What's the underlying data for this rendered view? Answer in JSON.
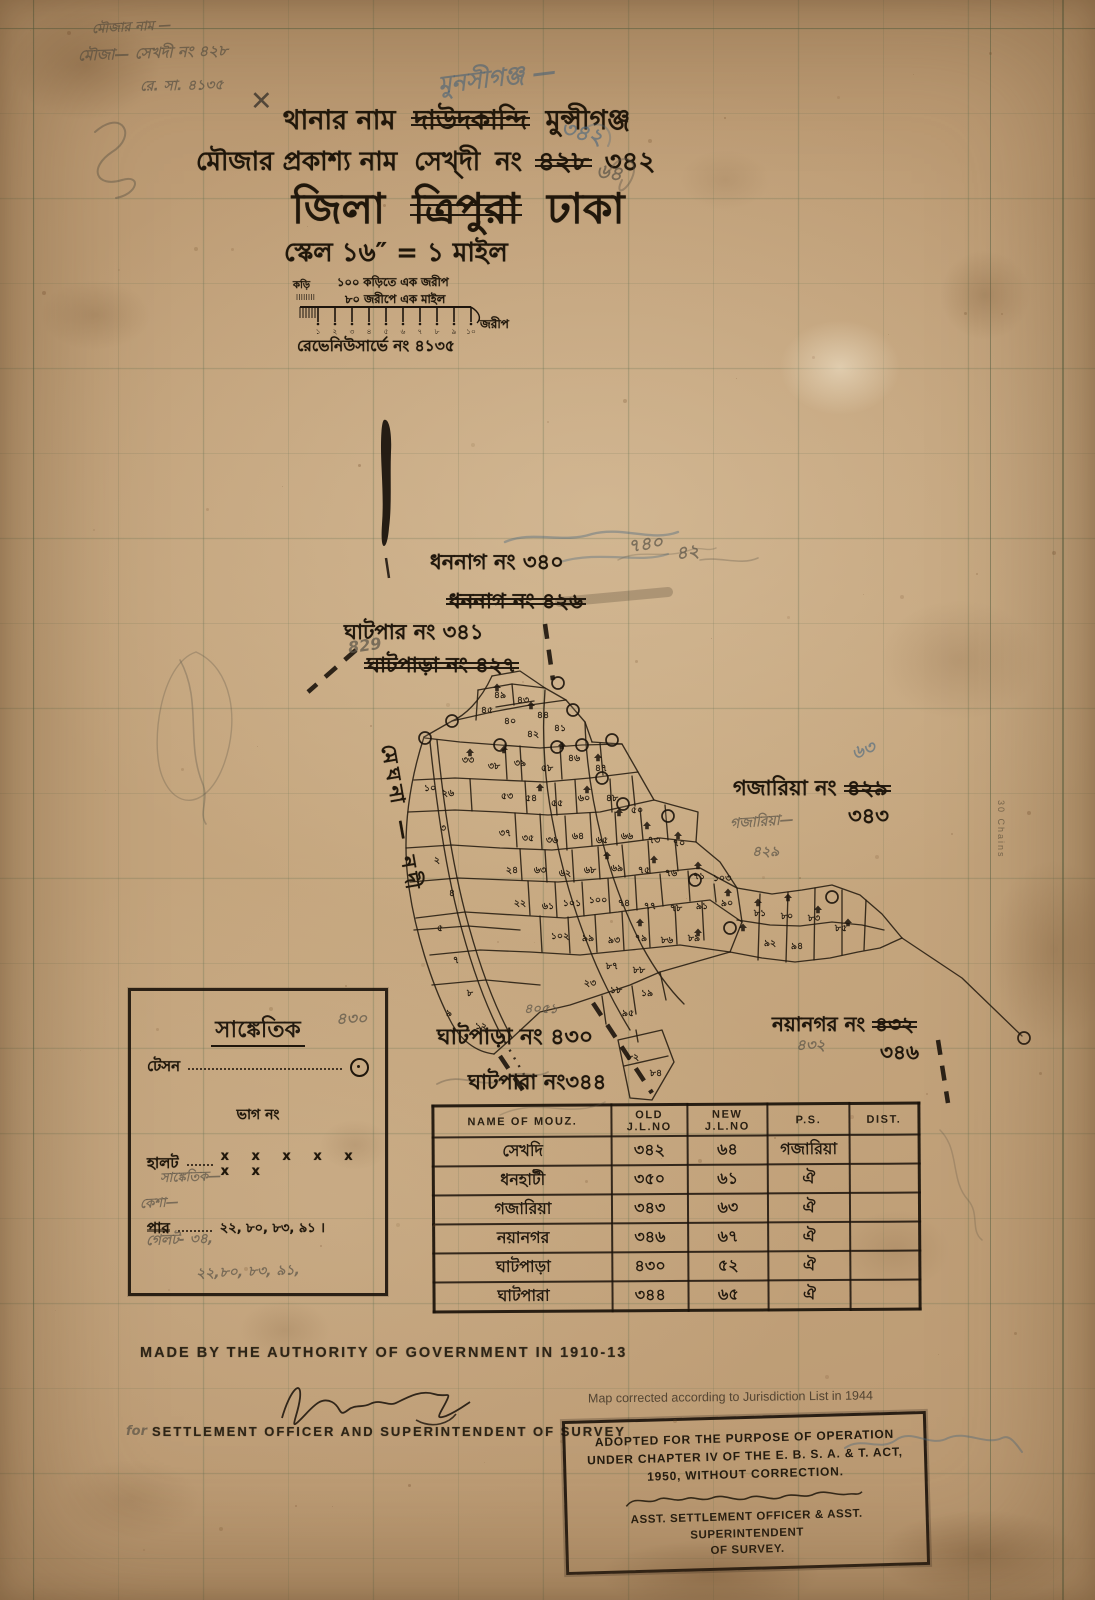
{
  "header": {
    "line1": {
      "prefix": "থানার নাম",
      "struck": "দাউদকান্দি",
      "value": "মুন্সীগঞ্জ"
    },
    "line2": {
      "prefix": "মৌজার প্রকাশ্য নাম",
      "name": "সেখ্দী",
      "no_label": "নং",
      "struck": "৪২৮",
      "value": "৩৪২"
    },
    "line3": {
      "prefix": "জিলা",
      "struck": "ত্রিপুরা",
      "value": "ঢাকা"
    },
    "scale_text": "স্কেল ১৬″ = ১ মাইল"
  },
  "scale_bar": {
    "label_top": "১০০ কড়িতে এক জরীপ",
    "label_bottom": "৮০ জরীপে এক মাইল",
    "label_left": "কড়ি",
    "label_right": "জরীপ",
    "ticks": [
      "১",
      "২",
      "৩",
      "৪",
      "৫",
      "৬",
      "৭",
      "৮",
      "৯",
      "১০"
    ]
  },
  "revenue_no": "রেভেনিউসার্ভে নং ৪১৩৫",
  "river_label": "মেঘনা — নদী",
  "margin": {
    "right_note": "30 Chains"
  },
  "boundary_labels": [
    {
      "x": 430,
      "y": 546,
      "s": 21,
      "parts": [
        {
          "t": "ধননাগ নং ৩৪০"
        }
      ]
    },
    {
      "x": 446,
      "y": 585,
      "s": 21,
      "parts": [
        {
          "t": "ধননাগ নং ৪২৬",
          "struck": true
        }
      ]
    },
    {
      "x": 344,
      "y": 616,
      "s": 21,
      "parts": [
        {
          "t": "ঘাটপার নং ৩৪১"
        }
      ]
    },
    {
      "x": 364,
      "y": 649,
      "s": 21,
      "parts": [
        {
          "t": "ঘাটপাড়া নং ৪২৭",
          "struck": true
        }
      ]
    },
    {
      "x": 733,
      "y": 772,
      "s": 21,
      "parts": [
        {
          "t": "গজারিয়া নং "
        },
        {
          "t": "৪২৯",
          "struck": true
        }
      ]
    },
    {
      "x": 848,
      "y": 800,
      "s": 21,
      "parts": [
        {
          "t": "৩৪৩"
        }
      ]
    },
    {
      "x": 772,
      "y": 1010,
      "s": 20,
      "parts": [
        {
          "t": "নয়ানগর নং "
        },
        {
          "t": "৪৩২",
          "struck": true
        }
      ]
    },
    {
      "x": 880,
      "y": 1038,
      "s": 20,
      "parts": [
        {
          "t": "৩৪৬"
        }
      ]
    },
    {
      "x": 437,
      "y": 1020,
      "s": 22,
      "parts": [
        {
          "t": "ঘাটপাড়া নং ৪৩০"
        }
      ]
    },
    {
      "x": 468,
      "y": 1066,
      "s": 21,
      "parts": [
        {
          "t": "ঘাটপারা নং৩৪৪"
        }
      ]
    }
  ],
  "pencil_notes": [
    {
      "x": 92,
      "y": 18,
      "t": "মৌজার নাম —",
      "c": "gray",
      "s": 13,
      "r": -3
    },
    {
      "x": 78,
      "y": 42,
      "t": "মৌজা— সেখদী নং ৪২৮",
      "c": "gray",
      "s": 15,
      "r": -2
    },
    {
      "x": 140,
      "y": 74,
      "t": "রে. সা. ৪১৩৫",
      "c": "gray",
      "s": 14,
      "r": -1
    },
    {
      "x": 438,
      "y": 60,
      "t": "মুনসীগঞ্জ —",
      "c": "blue",
      "s": 24,
      "r": -7
    },
    {
      "x": 560,
      "y": 116,
      "t": "৩৪২",
      "c": "blue",
      "s": 22,
      "r": 14
    },
    {
      "x": 596,
      "y": 158,
      "t": "৬৪",
      "c": "gray",
      "s": 20,
      "r": 10
    },
    {
      "x": 250,
      "y": 86,
      "t": "✕",
      "c": "dark",
      "s": 27,
      "r": 0
    },
    {
      "x": 628,
      "y": 530,
      "t": "৭৪০",
      "c": "gray",
      "s": 18,
      "r": -8
    },
    {
      "x": 676,
      "y": 538,
      "t": "৪২",
      "c": "gray",
      "s": 18,
      "r": -8
    },
    {
      "x": 348,
      "y": 636,
      "t": "829",
      "c": "gray",
      "s": 16,
      "r": -8
    },
    {
      "x": 852,
      "y": 736,
      "t": "৬৩",
      "c": "blue",
      "s": 18,
      "r": -18
    },
    {
      "x": 730,
      "y": 810,
      "t": "গজারিয়া—",
      "c": "gray",
      "s": 14,
      "r": -4
    },
    {
      "x": 752,
      "y": 840,
      "t": "৪২৯",
      "c": "gray",
      "s": 14,
      "r": 0
    },
    {
      "x": 524,
      "y": 1000,
      "t": "৪০৫১",
      "c": "gray",
      "s": 13,
      "r": 0
    },
    {
      "x": 336,
      "y": 1006,
      "t": "৪৩০",
      "c": "gray",
      "s": 16,
      "r": 0
    },
    {
      "x": 796,
      "y": 1034,
      "t": "৪৩২",
      "c": "gray",
      "s": 15,
      "r": 0
    },
    {
      "x": 160,
      "y": 1168,
      "t": "সাঙ্কেতিক—",
      "c": "gray",
      "s": 13,
      "r": -2
    },
    {
      "x": 140,
      "y": 1194,
      "t": "কেশা—",
      "c": "gray",
      "s": 13,
      "r": -3
    },
    {
      "x": 146,
      "y": 1228,
      "t": "গেলট- ৩৪,",
      "c": "gray",
      "s": 14,
      "r": -2
    },
    {
      "x": 196,
      "y": 1260,
      "t": "২২,৮০, ৮৩, ৯১,",
      "c": "gray",
      "s": 14,
      "r": -2
    },
    {
      "x": 126,
      "y": 1424,
      "t": "for",
      "c": "gray",
      "s": 13,
      "r": 0
    }
  ],
  "legend": {
    "title": "সাঙ্কেতিক",
    "items": [
      {
        "label": "টেসন",
        "type": "station"
      },
      {
        "label": "ভাগ নং",
        "type": "center"
      },
      {
        "label": "হালট",
        "type": "xline",
        "marks": "x  x  x  x  x  x  x"
      },
      {
        "label": "পার",
        "type": "dots",
        "value": "২২, ৮০, ৮৩, ৯১ ।"
      }
    ]
  },
  "table": {
    "headers": [
      "NAME OF MOUZ.",
      "OLD J.L.NO",
      "NEW J.L.NO",
      "P.S.",
      "DIST."
    ],
    "rows": [
      [
        "সেখদি",
        "৩৪২",
        "৬৪",
        "গজারিয়া",
        ""
      ],
      [
        "ধনহাটী",
        "৩৫০",
        "৬১",
        "ঐ",
        ""
      ],
      [
        "গজারিয়া",
        "৩৪৩",
        "৬৩",
        "ঐ",
        ""
      ],
      [
        "নয়ানগর",
        "৩৪৬",
        "৬৭",
        "ঐ",
        ""
      ],
      [
        "ঘাটপাড়া",
        "৪৩০",
        "৫২",
        "ঐ",
        ""
      ],
      [
        "ঘাটপারা",
        "৩৪৪",
        "৬৫",
        "ঐ",
        ""
      ]
    ]
  },
  "footer": {
    "made_by": "MADE BY THE AUTHORITY OF GOVERNMENT IN 1910-13",
    "officer_line": "SETTLEMENT OFFICER AND SUPERINTENDENT OF SURVEY",
    "corrected_note": "Map corrected according to  Jurisdiction List in 1944",
    "stamp": {
      "line1": "ADOPTED FOR THE PURPOSE OF OPERATION",
      "line2": "UNDER CHAPTER IV OF THE E. B. S. A. & T. ACT,",
      "line3": "1950, WITHOUT CORRECTION.",
      "officer1": "ASST. SETTLEMENT OFFICER & ASST. SUPERINTENDENT",
      "officer2": "OF SURVEY."
    }
  },
  "map": {
    "parcel_numbers": [
      [
        500,
        698,
        "৪৯"
      ],
      [
        523,
        703,
        "৪৩"
      ],
      [
        487,
        713,
        "৪৫"
      ],
      [
        543,
        718,
        "৪৪"
      ],
      [
        510,
        724,
        "৪০"
      ],
      [
        560,
        731,
        "৪১"
      ],
      [
        533,
        737,
        "৪২"
      ],
      [
        468,
        763,
        "৩৩"
      ],
      [
        494,
        769,
        "৩৮"
      ],
      [
        520,
        766,
        "৩৯"
      ],
      [
        547,
        771,
        "৫৮"
      ],
      [
        574,
        761,
        "৪৬"
      ],
      [
        601,
        771,
        "৪৭"
      ],
      [
        448,
        796,
        "২৬"
      ],
      [
        507,
        799,
        "৫৩"
      ],
      [
        531,
        801,
        "৫৪"
      ],
      [
        557,
        806,
        "৫৫"
      ],
      [
        584,
        801,
        "৬০"
      ],
      [
        612,
        801,
        "৪৮"
      ],
      [
        637,
        813,
        "৫০"
      ],
      [
        430,
        791,
        "১০"
      ],
      [
        443,
        831,
        "৩"
      ],
      [
        437,
        863,
        "২"
      ],
      [
        452,
        896,
        "৪"
      ],
      [
        440,
        931,
        "৫"
      ],
      [
        456,
        963,
        "৭"
      ],
      [
        470,
        996,
        "৮"
      ],
      [
        449,
        1016,
        "৯"
      ],
      [
        481,
        1029,
        "১২"
      ],
      [
        505,
        836,
        "৩৭"
      ],
      [
        528,
        841,
        "৩৫"
      ],
      [
        552,
        843,
        "৩৬"
      ],
      [
        578,
        839,
        "৬৪"
      ],
      [
        602,
        843,
        "৬৫"
      ],
      [
        627,
        839,
        "৬৬"
      ],
      [
        654,
        843,
        "৭৩"
      ],
      [
        679,
        846,
        "৭০"
      ],
      [
        512,
        873,
        "২৪"
      ],
      [
        540,
        873,
        "৬৩"
      ],
      [
        565,
        876,
        "৬২"
      ],
      [
        590,
        873,
        "৬৮"
      ],
      [
        617,
        871,
        "৬৯"
      ],
      [
        644,
        873,
        "৭৫"
      ],
      [
        671,
        876,
        "৭৬"
      ],
      [
        699,
        879,
        "৭১"
      ],
      [
        722,
        881,
        "১০৩"
      ],
      [
        520,
        906,
        "২২"
      ],
      [
        548,
        909,
        "৬১"
      ],
      [
        572,
        906,
        "১০১"
      ],
      [
        598,
        903,
        "১০০"
      ],
      [
        624,
        906,
        "৭৪"
      ],
      [
        650,
        909,
        "৭৭"
      ],
      [
        676,
        911,
        "৭৮"
      ],
      [
        702,
        909,
        "৯১"
      ],
      [
        727,
        906,
        "৯০"
      ],
      [
        560,
        939,
        "১০২"
      ],
      [
        588,
        941,
        "৯৯"
      ],
      [
        614,
        943,
        "৯৩"
      ],
      [
        641,
        941,
        "৭৯"
      ],
      [
        667,
        943,
        "৮৬"
      ],
      [
        694,
        941,
        "৮৯"
      ],
      [
        760,
        916,
        "৮১"
      ],
      [
        787,
        919,
        "৮০"
      ],
      [
        814,
        921,
        "৮৩"
      ],
      [
        841,
        931,
        "৮৫"
      ],
      [
        770,
        946,
        "৯২"
      ],
      [
        797,
        949,
        "৯৪"
      ],
      [
        612,
        969,
        "৮৭"
      ],
      [
        639,
        973,
        "৮৮"
      ],
      [
        590,
        986,
        "২৩"
      ],
      [
        616,
        993,
        "১৮"
      ],
      [
        647,
        996,
        "১৯"
      ],
      [
        628,
        1016,
        "৯৫"
      ],
      [
        633,
        1060,
        "৮২"
      ],
      [
        656,
        1076,
        "৮৪"
      ]
    ],
    "huts": [
      [
        497,
        688
      ],
      [
        531,
        706
      ],
      [
        470,
        753
      ],
      [
        504,
        750
      ],
      [
        562,
        746
      ],
      [
        598,
        758
      ],
      [
        540,
        788
      ],
      [
        587,
        790
      ],
      [
        619,
        813
      ],
      [
        647,
        826
      ],
      [
        678,
        836
      ],
      [
        607,
        856
      ],
      [
        654,
        860
      ],
      [
        698,
        866
      ],
      [
        728,
        893
      ],
      [
        758,
        903
      ],
      [
        788,
        898
      ],
      [
        818,
        910
      ],
      [
        848,
        923
      ],
      [
        698,
        933
      ],
      [
        743,
        928
      ],
      [
        640,
        923
      ]
    ],
    "stations": [
      [
        558,
        683
      ],
      [
        573,
        710
      ],
      [
        452,
        721
      ],
      [
        425,
        738
      ],
      [
        500,
        745
      ],
      [
        557,
        747
      ],
      [
        582,
        745
      ],
      [
        612,
        740
      ],
      [
        602,
        778
      ],
      [
        623,
        804
      ],
      [
        668,
        816
      ],
      [
        695,
        880
      ],
      [
        730,
        928
      ],
      [
        832,
        897
      ],
      [
        1024,
        1038
      ]
    ]
  }
}
